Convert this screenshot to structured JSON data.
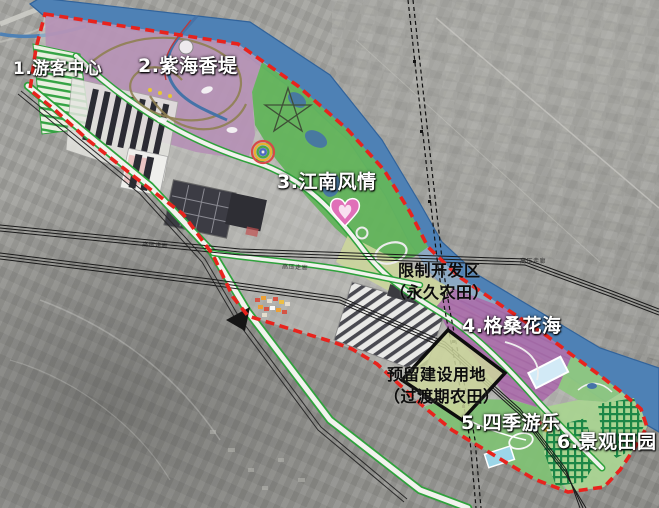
{
  "map": {
    "zone_labels": [
      {
        "id": "1",
        "label": "1.游客中心"
      },
      {
        "id": "2",
        "label": "2.紫海香堤"
      },
      {
        "id": "3",
        "label": "3.江南风情"
      },
      {
        "id": "4",
        "label": "4.格桑花海"
      },
      {
        "id": "5",
        "label": "5.四季游乐"
      },
      {
        "id": "6",
        "label": "6.景观田园"
      }
    ],
    "annotations": {
      "restricted_zone_line1": "限制开发区",
      "restricted_zone_line2": "（永久农田）",
      "reserved_land_line1": "预留建设用地",
      "reserved_land_line2": "（过渡期农田）",
      "power_corridor": "高压走廊"
    },
    "colors": {
      "boundary_red": "#e8231d",
      "river_blue": "#4e81b5",
      "zone_purple": "#b58fb5",
      "zone_magenta": "#ab6dab",
      "zone_green": "#5db455",
      "zone5_green": "#7cc070",
      "farmland_yellow_green": "#ccd69c",
      "maze_light": "#a8d490",
      "maze_green": "#1d8747",
      "road_edge_green": "#2fa23c"
    }
  }
}
